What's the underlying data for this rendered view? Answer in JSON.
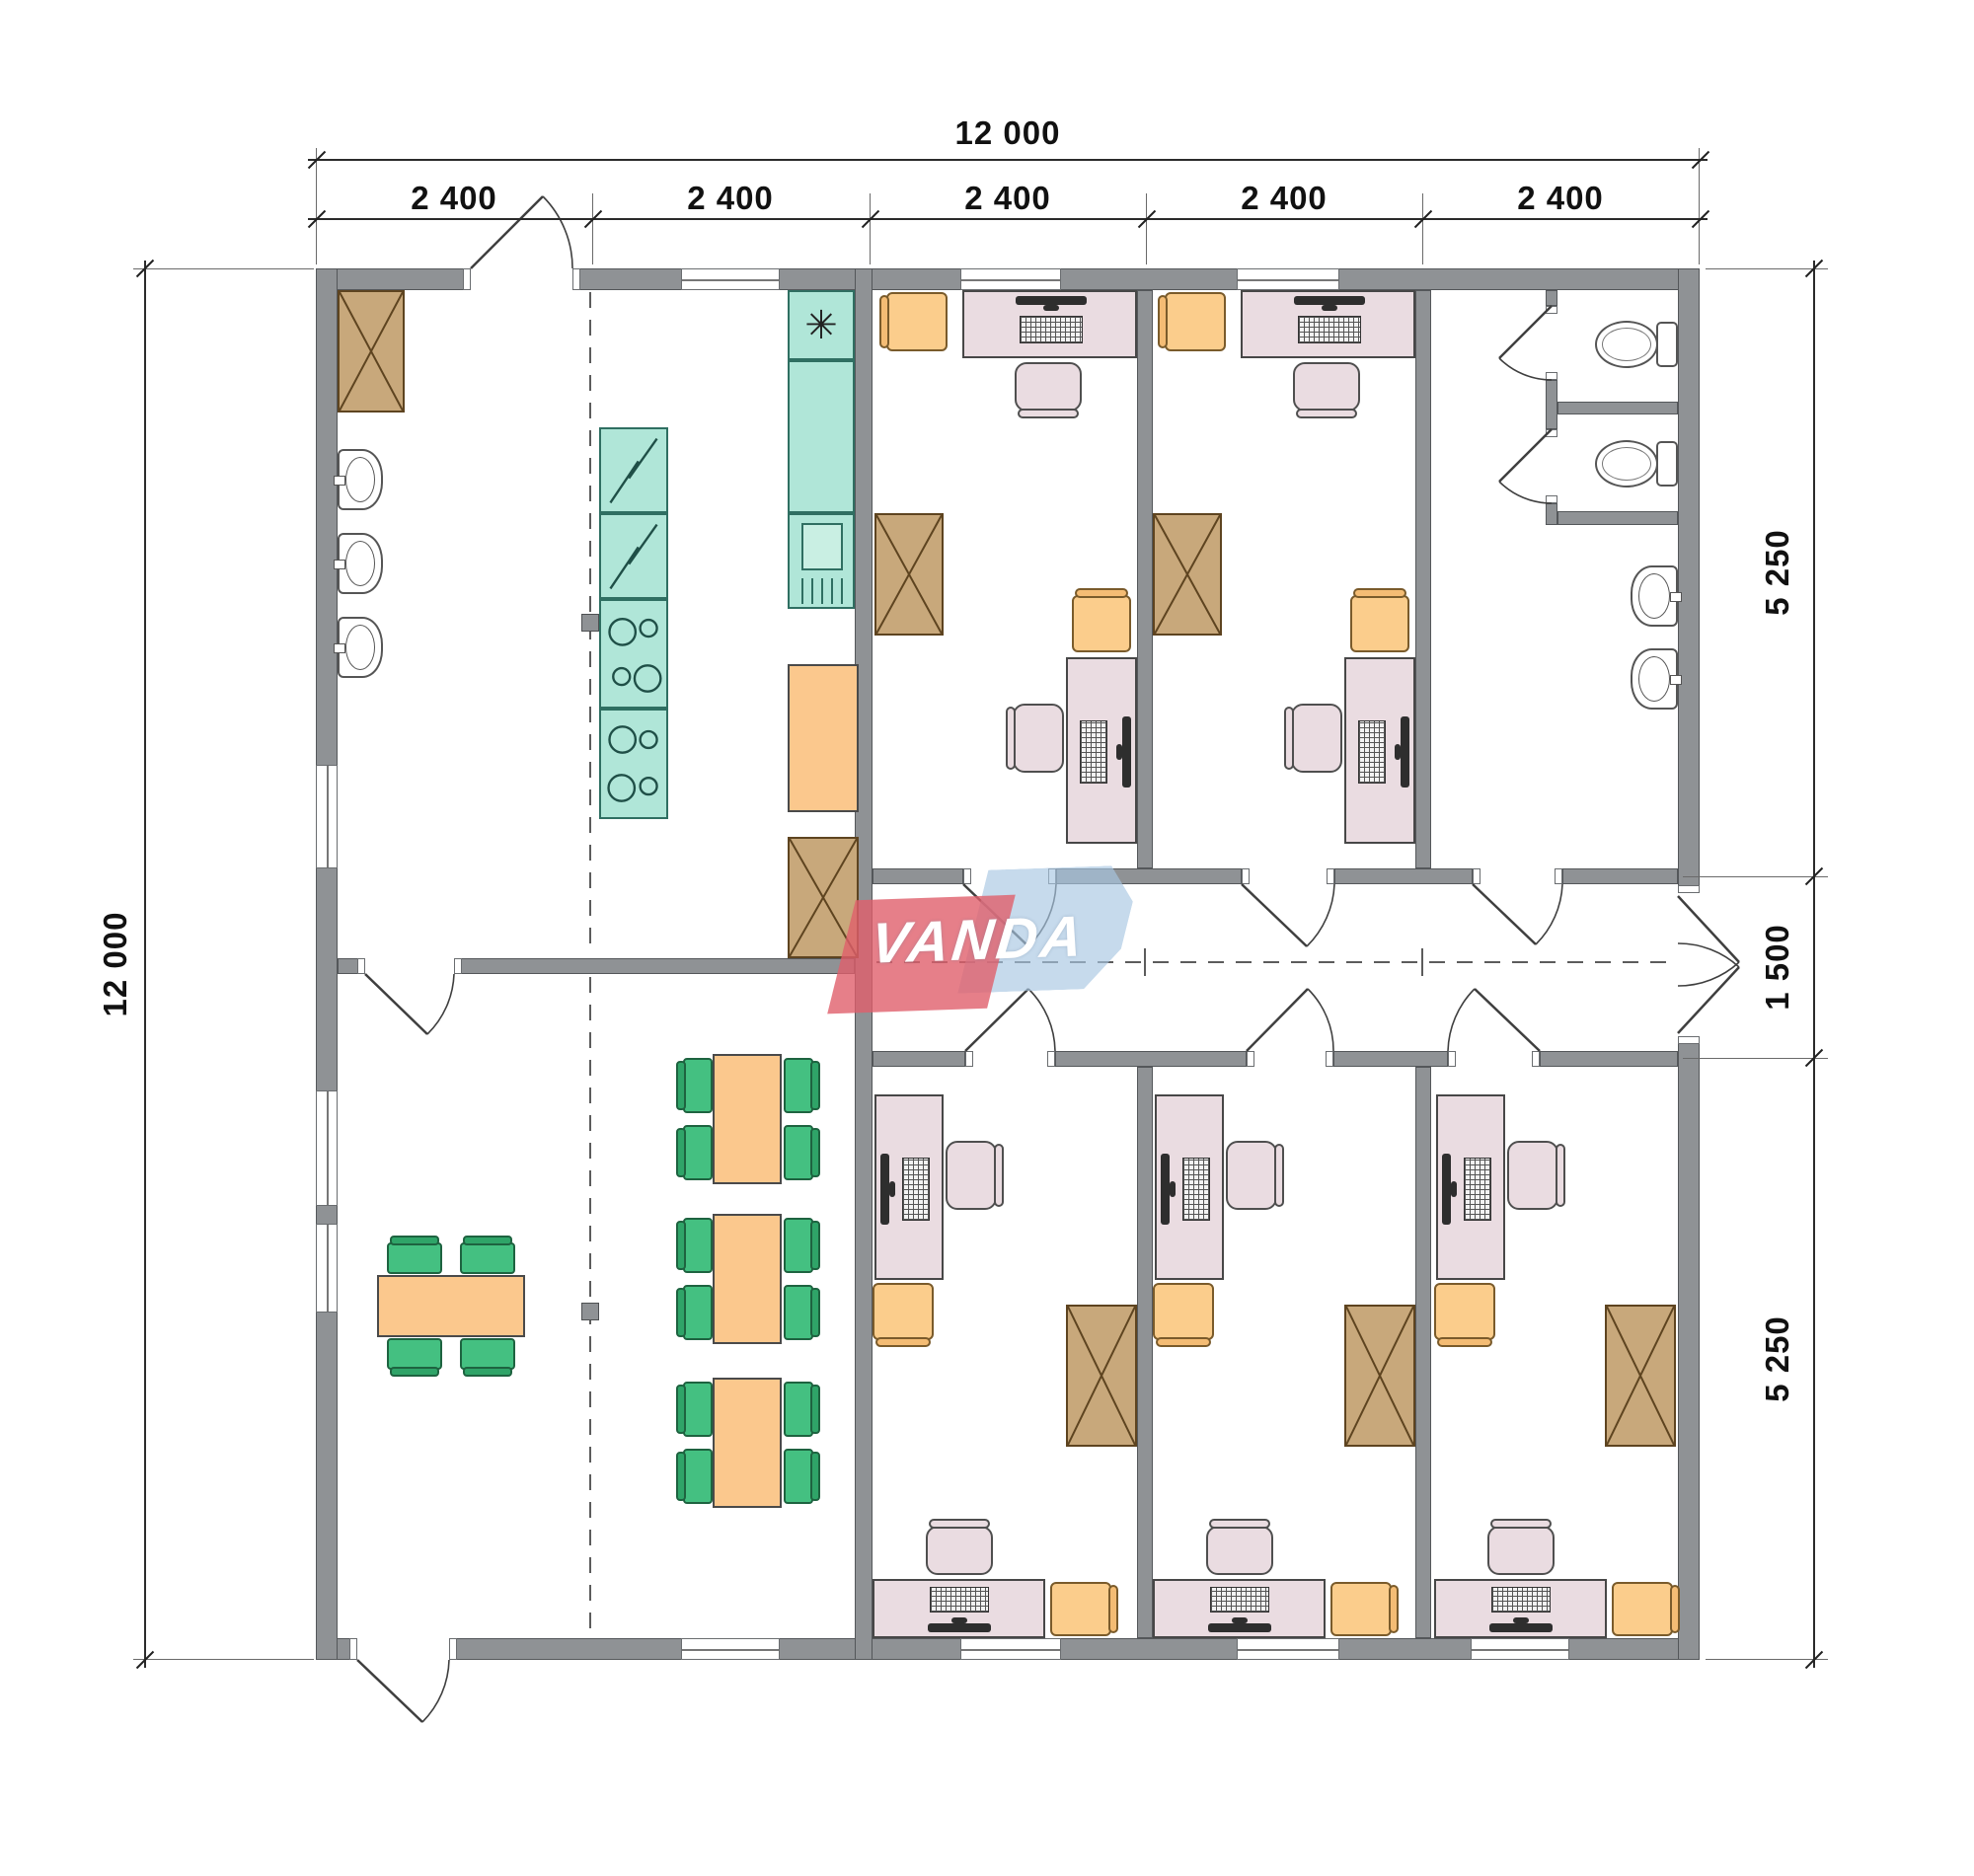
{
  "dimensions": {
    "top": {
      "total": "12 000",
      "segments": [
        "2 400",
        "2 400",
        "2 400",
        "2 400",
        "2 400"
      ]
    },
    "left": {
      "total": "12 000"
    },
    "right": {
      "segments": [
        "5 250",
        "1 500",
        "5 250"
      ]
    }
  },
  "logo": {
    "text": "VANDA"
  },
  "symbols": {
    "freezer_star": "✳"
  },
  "colors": {
    "wall": "#8f9295",
    "desk": "#eadce1",
    "visitor_chair": "#fbcd8c",
    "dining_chair": "#44c081",
    "cabinet": "#c8a87b",
    "kitchen_unit": "#b0e6d8",
    "table": "#fbc88d"
  }
}
